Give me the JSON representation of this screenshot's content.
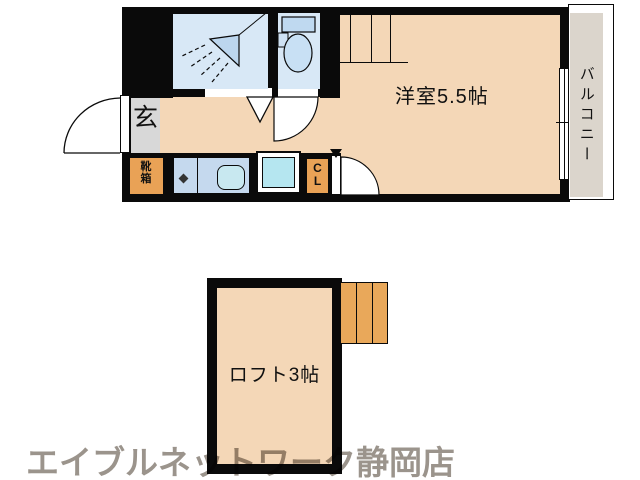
{
  "colors": {
    "wall": "#0a0a0a",
    "floor": "#f4d7b7",
    "wet_room_blue": "#d8e8f6",
    "kitchen_blue": "#c5d9ee",
    "sink_cyan": "#b5e6f0",
    "storage_orange": "#e9a256",
    "stairs_orange": "#e9a85a",
    "entrance_gray": "#d8d8d8",
    "balcony_gray": "#dbd5cc",
    "watermark_gray": "#9b948c"
  },
  "upper_floor": {
    "main_room_label": "洋室5.5帖",
    "entrance_label": "玄",
    "shoe_box_label": "靴箱",
    "closet_label": "CL",
    "balcony_label": "バルコニー"
  },
  "loft_floor": {
    "loft_label": "ロフト3帖"
  },
  "watermark": {
    "store_name": "エイブルネットワーク静岡店"
  }
}
